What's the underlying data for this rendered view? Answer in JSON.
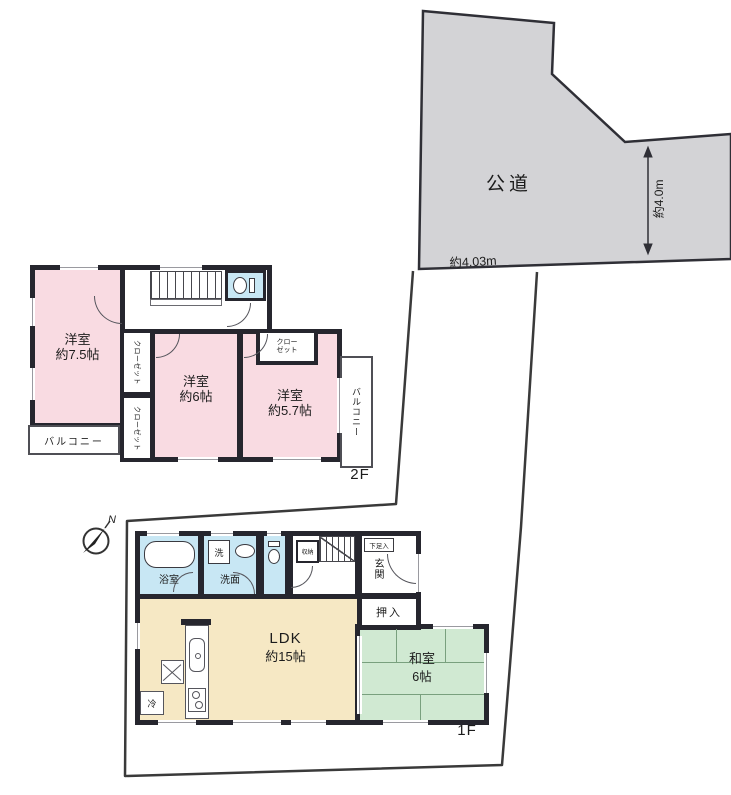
{
  "site": {
    "road_label": "公道",
    "road_width": "約4.0m",
    "frontage": "約4.03m",
    "compass_north": "N"
  },
  "floor2": {
    "label": "2F",
    "room75_name": "洋室",
    "room75_size": "約7.5帖",
    "room6_name": "洋室",
    "room6_size": "約6帖",
    "room57_name": "洋室",
    "room57_size": "約5.7帖",
    "closet_left_upper": "クローゼット",
    "closet_left_lower": "クローゼット",
    "closet57_line1": "クロー",
    "closet57_line2": "ゼット",
    "balcony_right": "バルコニー",
    "balcony_bottom": "バルコニー"
  },
  "floor1": {
    "label": "1F",
    "bath": "浴室",
    "washer": "洗",
    "washroom": "洗面",
    "storage": "収納",
    "shoe_cabinet": "下足入",
    "entrance": "玄関",
    "closet": "押入",
    "ldk_line1": "LDK",
    "ldk_line2": "約15帖",
    "washitsu_line1": "和室",
    "washitsu_line2": "6帖",
    "fridge": "冷"
  },
  "colors": {
    "road_fill": "#d3d3d6",
    "room_pink": "#f9dbe2",
    "water_blue": "#c8e7f4",
    "ldk_cream": "#f6e8c4",
    "tatami_green": "#d0e9d2",
    "wall_dark": "#26262e"
  }
}
